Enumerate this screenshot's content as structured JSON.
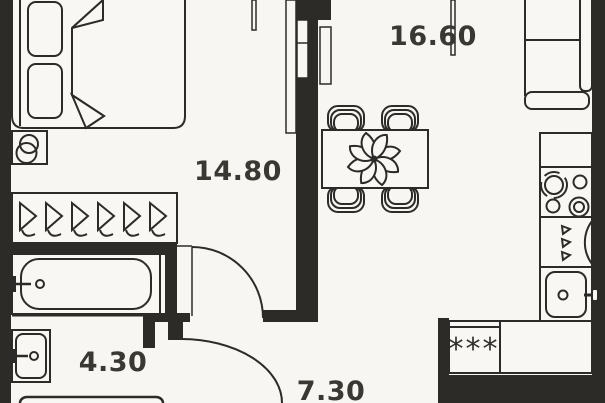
{
  "title": "Apartment floor plan",
  "colors": {
    "background": "#f7f6f2",
    "wall": "#2d2b28",
    "line": "#2c2b29",
    "text": "#3a3832"
  },
  "rooms": [
    {
      "name": "living-kitchen",
      "area": "16.60"
    },
    {
      "name": "bedroom",
      "area": "14.80"
    },
    {
      "name": "bathroom",
      "area": "4.30"
    },
    {
      "name": "hallway",
      "area": "7.30"
    }
  ],
  "symbols": {
    "washing_machine": "***"
  },
  "furniture": [
    "bed",
    "pillows",
    "blanket",
    "wall-hooks",
    "wardrobe-with-hangers",
    "bathtub",
    "washbasin",
    "toilet",
    "dining-table",
    "chairs",
    "flower-decor",
    "sofa",
    "kitchen-counter",
    "stove",
    "dishwasher",
    "kitchen-sink",
    "washing-machine",
    "swing-doors",
    "sliding-door-panels",
    "window-lines"
  ]
}
